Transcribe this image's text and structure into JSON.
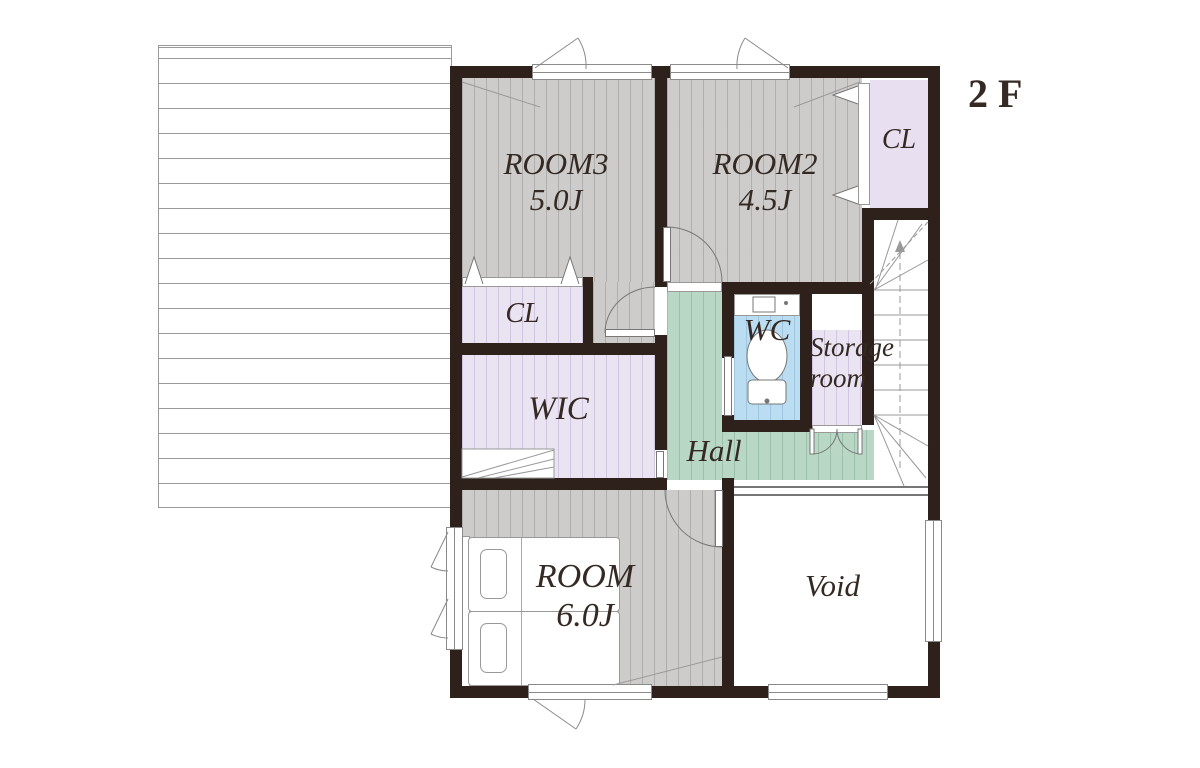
{
  "floor_label": "2F",
  "rooms": {
    "room3": {
      "name": "ROOM3",
      "size": "5.0J"
    },
    "room2": {
      "name": "ROOM2",
      "size": "4.5J"
    },
    "closet_top": {
      "name": "CL"
    },
    "closet_left": {
      "name": "CL"
    },
    "wic": {
      "name": "WIC"
    },
    "wc": {
      "name": "WC"
    },
    "storage": {
      "name_line1": "Storage",
      "name_line2": "room"
    },
    "hall": {
      "name": "Hall"
    },
    "room1": {
      "name": "ROOM",
      "size": "6.0J"
    },
    "void": {
      "name": "Void"
    }
  },
  "colors": {
    "wall": "#2e211b",
    "floor_wood": "#cdcccb",
    "closet": "#e9e1f1",
    "hall": "#b8d6c4",
    "wc": "#b9dcf0",
    "roof_line": "#9a9a9a",
    "text": "#342a23"
  }
}
